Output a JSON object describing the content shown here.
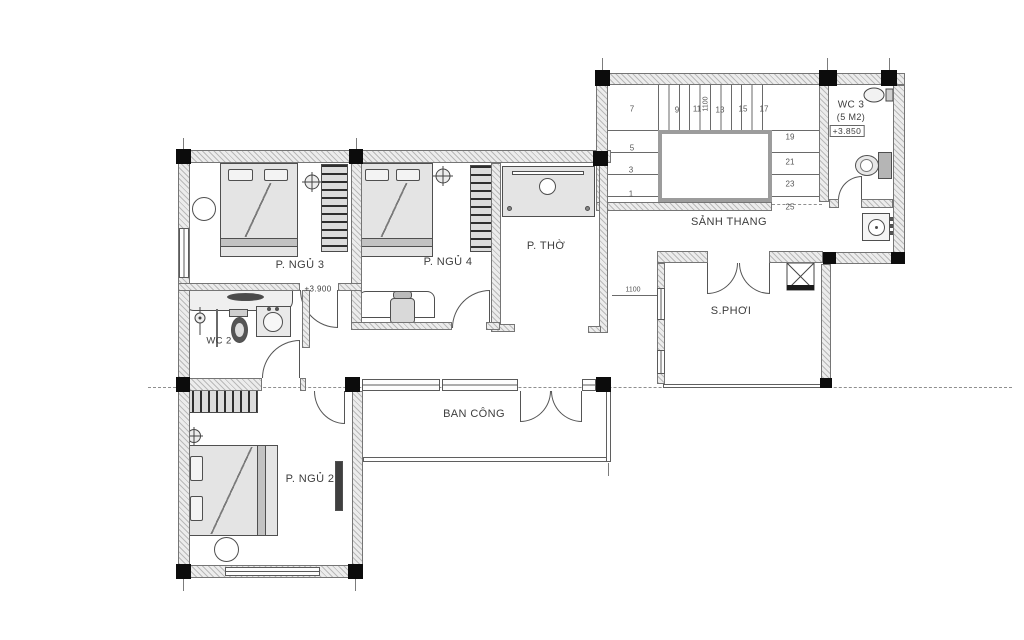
{
  "drawing": {
    "rooms": {
      "bedroom2": "P. NGỦ 2",
      "bedroom3": "P. NGỦ 3",
      "bedroom4": "P. NGỦ 4",
      "worship": "P. THỜ",
      "stair_hall": "SẢNH THANG",
      "drying_yard": "S.PHƠI",
      "balcony": "BAN CÔNG",
      "wc2": "WC 2",
      "wc3": "WC 3",
      "wc3_area": "(5 M2)",
      "wc3_level": "+3.850",
      "floor_level": "+3.900"
    },
    "dimensions": {
      "stair_flight_width": "1100",
      "passage_width": "1100"
    },
    "stairs": {
      "steps": [
        "7",
        "9",
        "11",
        "13",
        "15",
        "17",
        "19",
        "21",
        "23",
        "25",
        "5",
        "3",
        "1"
      ]
    },
    "colors": {
      "line": "#555555",
      "wall_fill": "#e0e0e0",
      "column": "#0c0c0c",
      "background": "#ffffff"
    }
  }
}
